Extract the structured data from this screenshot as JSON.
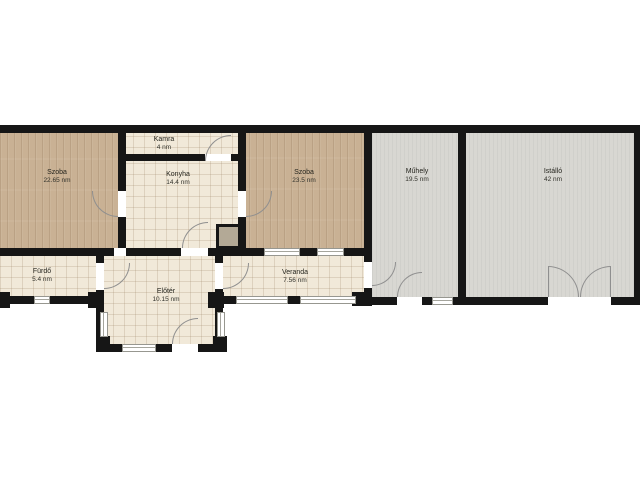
{
  "plan": {
    "title": "floor-plan",
    "rooms": [
      {
        "name": "Szoba",
        "area": "22.65 nm"
      },
      {
        "name": "Kamra",
        "area": "4 nm"
      },
      {
        "name": "Konyha",
        "area": "14.4 nm"
      },
      {
        "name": "Szoba",
        "area": "23.5 nm"
      },
      {
        "name": "Műhely",
        "area": "19.5 nm"
      },
      {
        "name": "Istálló",
        "area": "42 nm"
      },
      {
        "name": "Fürdő",
        "area": "5.4 nm"
      },
      {
        "name": "Előtér",
        "area": "10.15 nm"
      },
      {
        "name": "Veranda",
        "area": "7.56 nm"
      }
    ],
    "colors": {
      "wall": "#161616",
      "wood_floor": "#c9b194",
      "tile_floor": "#f1e9d9",
      "concrete_floor": "#d8d7d2",
      "door_arc": "#8f8f8f",
      "chimney": "#b3a996",
      "background": "#ffffff"
    }
  }
}
